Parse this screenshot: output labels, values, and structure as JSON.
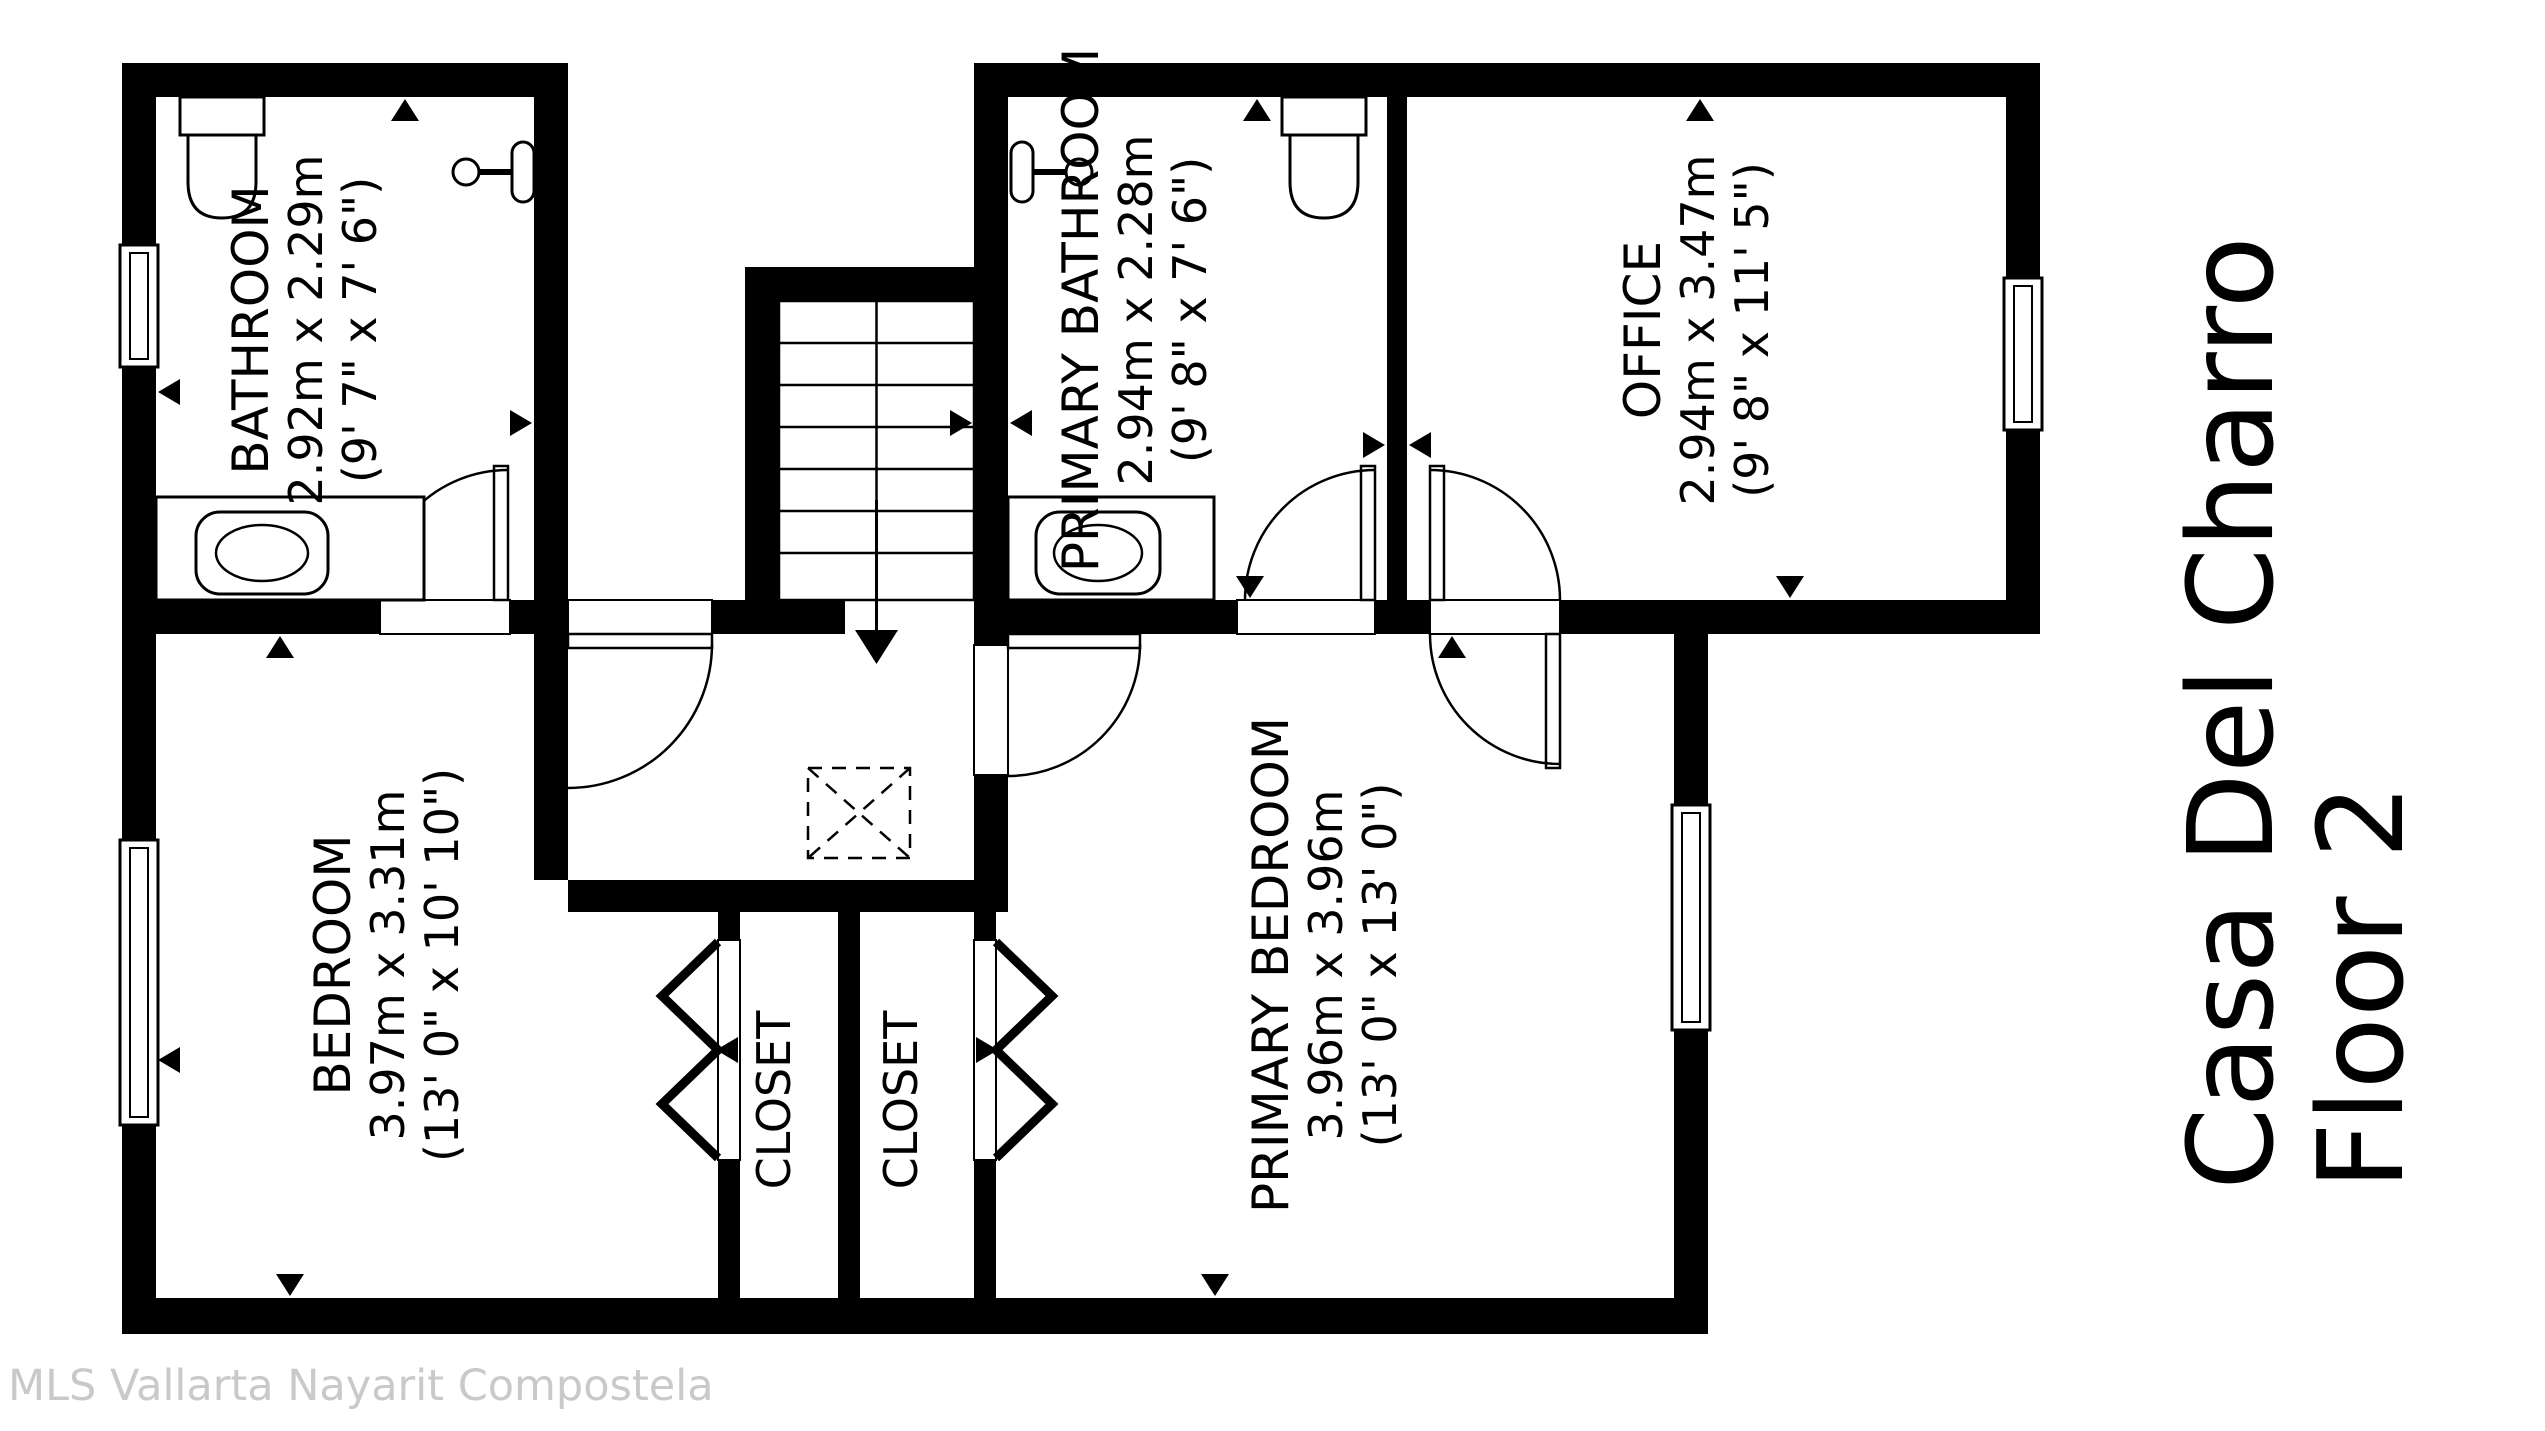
{
  "title": {
    "line1": "Casa Del Charro",
    "line2": "Floor 2"
  },
  "watermark": "MLS Vallarta Nayarit Compostela",
  "rooms": {
    "bathroom": {
      "name": "BATHROOM",
      "metric": "2.92m x 2.29m",
      "imperial": "(9' 7\" x 7' 6\")"
    },
    "primary_bathroom": {
      "name": "PRIMARY BATHROOM",
      "metric": "2.94m x 2.28m",
      "imperial": "(9' 8\" x 7' 6\")"
    },
    "office": {
      "name": "OFFICE",
      "metric": "2.94m x 3.47m",
      "imperial": "(9' 8\" x 11' 5\")"
    },
    "bedroom": {
      "name": "BEDROOM",
      "metric": "3.97m x 3.31m",
      "imperial": "(13' 0\" x 10' 10\")"
    },
    "primary_bedroom": {
      "name": "PRIMARY BEDROOM",
      "metric": "3.96m x 3.96m",
      "imperial": "(13' 0\" x 13' 0\")"
    },
    "closet_left": {
      "name": "CLOSET"
    },
    "closet_right": {
      "name": "CLOSET"
    }
  },
  "colors": {
    "walls": "#000000",
    "background": "#ffffff",
    "watermark": "#c9c9c9"
  }
}
